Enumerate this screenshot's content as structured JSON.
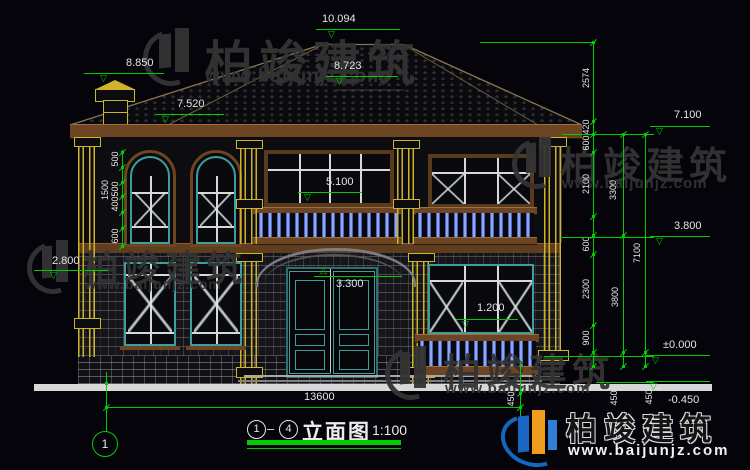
{
  "colors": {
    "cad_green": "#00cc00",
    "dim_text": "#e5e5e5",
    "yellow": "#cdb42a",
    "brown": "#6e4523",
    "teal": "#3e9d9d",
    "baluster_blue": "#5578d8",
    "ground_white": "#d8d8d8"
  },
  "watermark": {
    "brand": "柏竣建筑",
    "url": "www.baijunjz.com"
  },
  "title_block": {
    "grid_start": "1",
    "dash": "–",
    "grid_end": "4",
    "name": "立面图",
    "scale": "1:100"
  },
  "grid_bubble": {
    "label": "1"
  },
  "bottom_dim": {
    "label": "13600",
    "y": 407,
    "x1": 106,
    "x2": 520,
    "tx": 304,
    "ty": 391
  },
  "level_markers": [
    {
      "label": "10.094",
      "tx": 322,
      "ty": 13,
      "lx": 316,
      "lw": 84,
      "ly": 29,
      "ax": 328,
      "dir": "down"
    },
    {
      "label": "8.850",
      "tx": 126,
      "ty": 57,
      "lx": 84,
      "lw": 80,
      "ly": 73,
      "ax": 100,
      "dir": "down"
    },
    {
      "label": "8.723",
      "tx": 334,
      "ty": 60,
      "lx": 326,
      "lw": 72,
      "ly": 76,
      "ax": 336,
      "dir": "down"
    },
    {
      "label": "7.520",
      "tx": 177,
      "ty": 98,
      "lx": 156,
      "lw": 68,
      "ly": 114,
      "ax": 162,
      "dir": "down"
    },
    {
      "label": "7.100",
      "tx": 674,
      "ty": 109,
      "lx": 650,
      "lw": 60,
      "ly": 126,
      "ax": 656,
      "dir": "down"
    },
    {
      "label": "5.100",
      "tx": 326,
      "ty": 176,
      "lx": 298,
      "lw": 64,
      "ly": 192,
      "ax": 304,
      "dir": "down"
    },
    {
      "label": "3.800",
      "tx": 674,
      "ty": 220,
      "lx": 650,
      "lw": 60,
      "ly": 236,
      "ax": 656,
      "dir": "down"
    },
    {
      "label": "3.300",
      "tx": 336,
      "ty": 278,
      "lx": 314,
      "lw": 88,
      "ly": 276,
      "ax": 320,
      "dir": "up"
    },
    {
      "label": "2.800",
      "tx": 52,
      "ty": 255,
      "lx": 34,
      "lw": 62,
      "ly": 270,
      "ax": 50,
      "dir": "down"
    },
    {
      "label": "1.200",
      "tx": 477,
      "ty": 302,
      "lx": 456,
      "lw": 62,
      "ly": 319,
      "ax": 462,
      "dir": "down"
    },
    {
      "label": "±0.000",
      "tx": 663,
      "ty": 339,
      "lx": 646,
      "lw": 64,
      "ly": 355,
      "ax": 652,
      "dir": "down"
    },
    {
      "label": "-0.450",
      "tx": 668,
      "ty": 394,
      "lx": 646,
      "lw": 64,
      "ly": 381,
      "ax": 650,
      "dir": "down"
    }
  ],
  "dim_chains": [
    {
      "x": 593,
      "y1": 42,
      "y2": 366,
      "ticks": [
        42,
        121,
        134,
        152,
        216,
        235,
        254,
        325,
        352,
        366
      ],
      "labels": [
        {
          "t": "2574",
          "y": 78,
          "dx": -7
        },
        {
          "t": "420",
          "y": 127,
          "dx": -7
        },
        {
          "t": "600",
          "y": 143,
          "dx": -7
        },
        {
          "t": "2100",
          "y": 184,
          "dx": -7
        },
        {
          "t": "600",
          "y": 244,
          "dx": -7
        },
        {
          "t": "2300",
          "y": 289,
          "dx": -7
        },
        {
          "t": "900",
          "y": 338,
          "dx": -7
        }
      ]
    },
    {
      "x": 623,
      "y1": 134,
      "y2": 366,
      "ticks": [
        134,
        235,
        352,
        366
      ],
      "labels": [
        {
          "t": "3300",
          "y": 190,
          "dx": -10
        },
        {
          "t": "3800",
          "y": 297,
          "dx": -8
        },
        {
          "t": "450",
          "y": 398,
          "dx": -9
        }
      ]
    },
    {
      "x": 645,
      "y1": 134,
      "y2": 366,
      "ticks": [
        134,
        352,
        366
      ],
      "labels": [
        {
          "t": "7100",
          "y": 253,
          "dx": -8
        },
        {
          "t": "450",
          "y": 397,
          "dx": 4
        }
      ]
    },
    {
      "x": 122,
      "y1": 150,
      "y2": 246,
      "ticks": [
        152,
        167,
        182,
        196,
        212,
        228,
        246
      ],
      "labels": [
        {
          "t": "500",
          "y": 159,
          "dx": -7
        },
        {
          "t": "1500",
          "y": 190,
          "dx": -17
        },
        {
          "t": "500",
          "y": 189,
          "dx": -7
        },
        {
          "t": "400",
          "y": 204,
          "dx": -7
        },
        {
          "t": "600",
          "y": 236,
          "dx": -7
        }
      ]
    },
    {
      "x": 520,
      "y1": 362,
      "y2": 452,
      "ticks": [
        393,
        407
      ],
      "labels": [
        {
          "t": "450",
          "y": 399,
          "dx": -9
        }
      ]
    }
  ],
  "ext_lines": [
    {
      "x": 480,
      "y": 42,
      "w": 112,
      "h": 1
    },
    {
      "x": 562,
      "y": 134,
      "w": 92,
      "h": 1
    },
    {
      "x": 562,
      "y": 237,
      "w": 92,
      "h": 1
    },
    {
      "x": 544,
      "y": 356,
      "w": 110,
      "h": 1
    },
    {
      "x": 596,
      "y": 382,
      "w": 58,
      "h": 1
    },
    {
      "x": 106,
      "y": 372,
      "w": 1,
      "h": 60
    },
    {
      "x": 96,
      "y": 270,
      "w": 12,
      "h": 1
    }
  ],
  "nodes": [
    {
      "x": 106,
      "y": 383
    },
    {
      "x": 106,
      "y": 407
    },
    {
      "x": 593,
      "y": 42
    }
  ]
}
